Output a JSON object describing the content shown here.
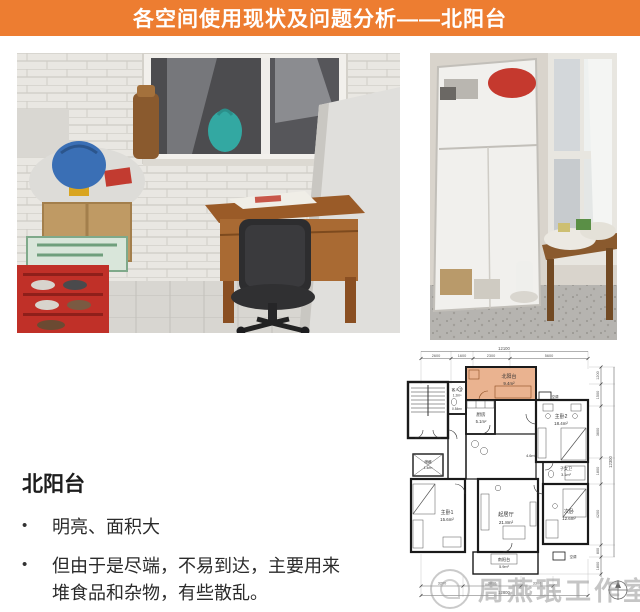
{
  "banner": {
    "title": "各空间使用现状及问题分析——北阳台",
    "bg_color": "#ED7D31"
  },
  "analysis": {
    "heading": "北阳台",
    "bullet_marker": "•",
    "bullets": [
      "明亮、面积大",
      "但由于是尽端，不易到达，主要用来堆食品和杂物，有些散乱。"
    ]
  },
  "floor_plan": {
    "highlight_color": "#E39A6B",
    "dims": {
      "top_overall": "12100",
      "top_segments": [
        "2600",
        "1600",
        "2300",
        "5600"
      ],
      "right_overall": "12300",
      "right_segments": [
        "1200",
        "1500",
        "3600",
        "1800",
        "4200",
        "800"
      ],
      "right_south_balcony": "1800",
      "bottom_overall": "12800",
      "bottom_segments": [
        "3200",
        "3800",
        "3300"
      ]
    },
    "rooms": {
      "north_balcony_name": "北阳台",
      "north_balcony_area": "9.4m²",
      "kitchen_name": "厨房",
      "kitchen_area": "5.1m²",
      "guest_bath_name": "客人卫",
      "guest_bath_area": "1.2m²",
      "closet_area": "0.54m²",
      "master2_name": "主卧2",
      "master2_area": "18.4m²",
      "hall_area": "4.6m²",
      "kids_bath_name": "子女卫",
      "kids_bath_area": "3.1m²",
      "storage_name": "储藏",
      "storage_area": "1.4m²",
      "master1_name": "主卧1",
      "master1_area": "15.6m²",
      "living_name": "起居厅",
      "living_area": "21.8m²",
      "bedroom2_name": "次卧",
      "bedroom2_area": "12.6m²",
      "south_balcony_name": "南阳台",
      "south_balcony_area": "5.9m²",
      "ac_label": "空调"
    }
  },
  "watermark": {
    "text": "周燕珉工作室"
  }
}
